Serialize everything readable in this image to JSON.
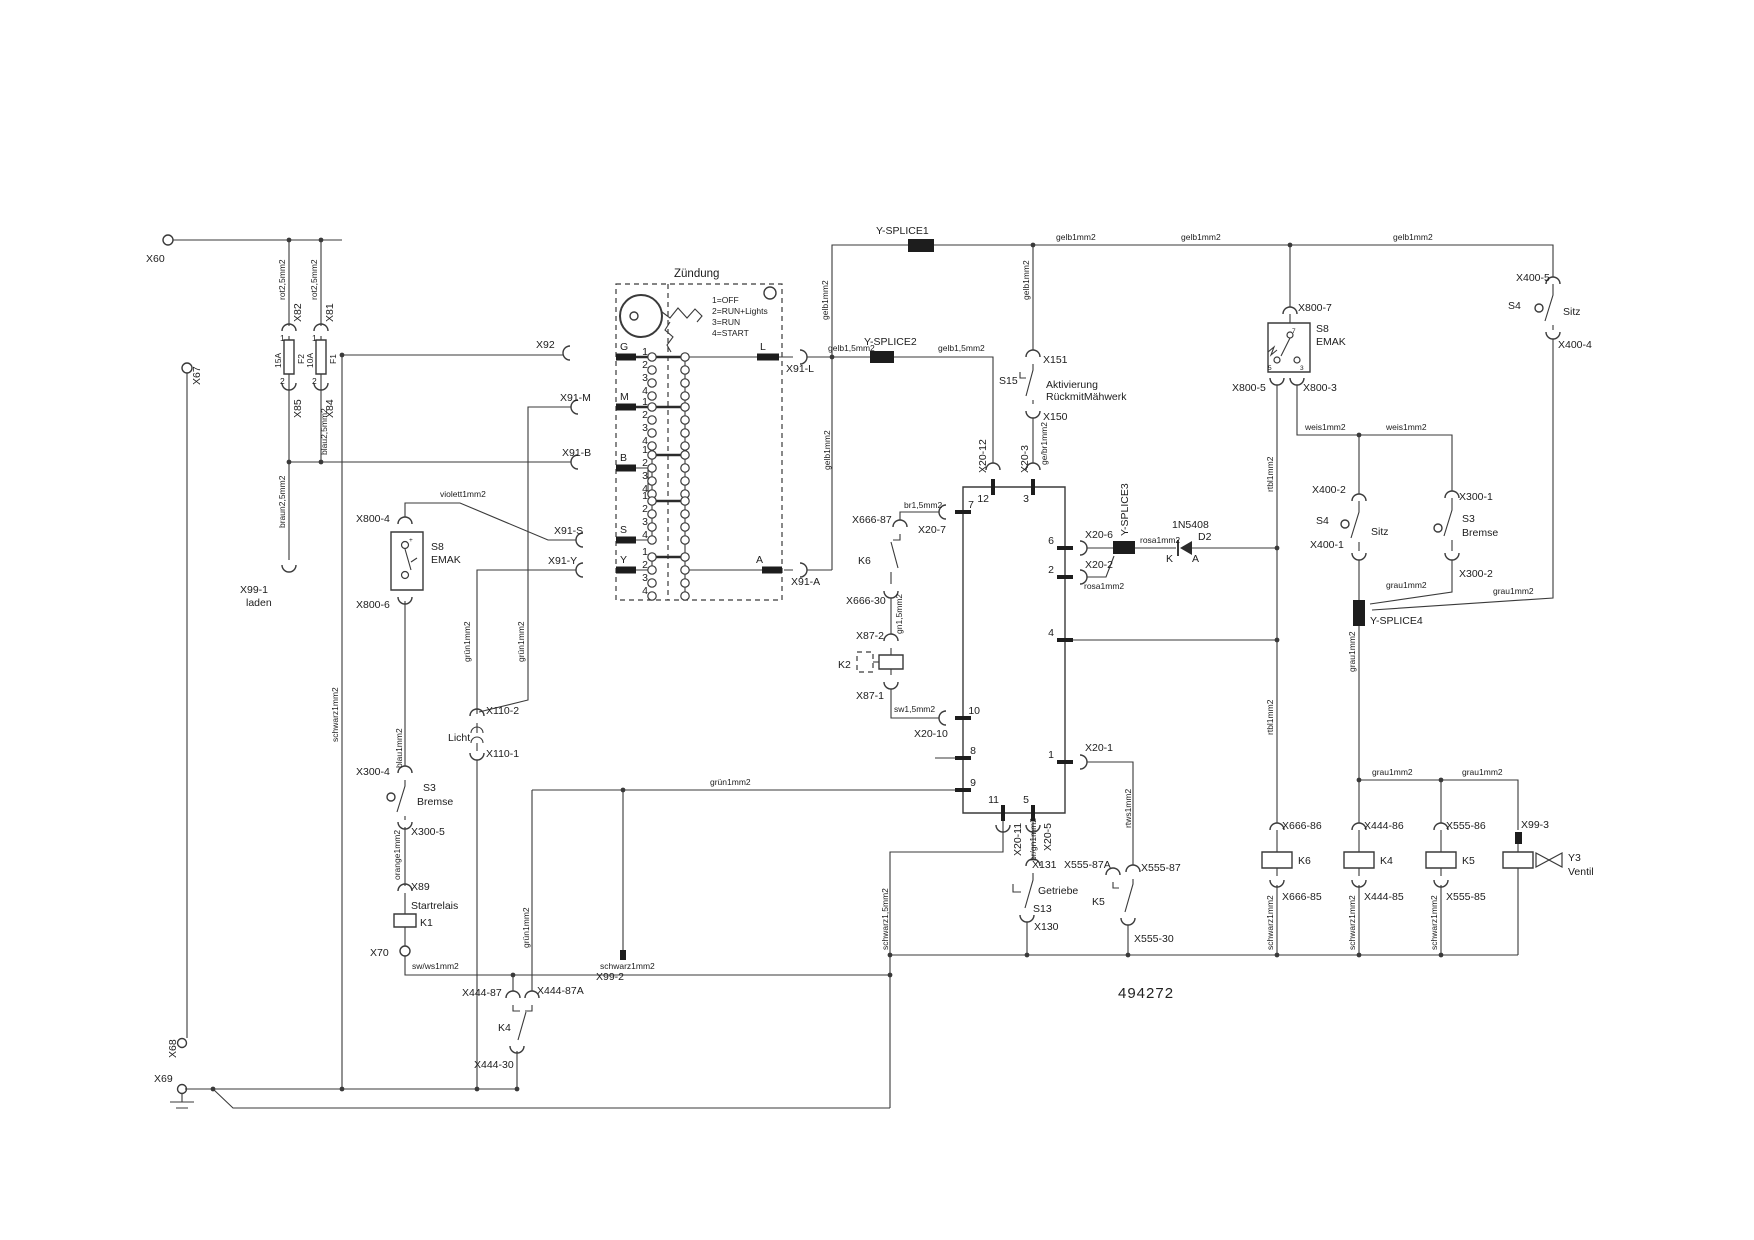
{
  "doc_number": "494272",
  "ignition": {
    "title": "Zündung",
    "pos1": "1=OFF",
    "pos2": "2=RUN+Lights",
    "pos3": "3=RUN",
    "pos4": "4=START",
    "terminals": {
      "g": "G",
      "m": "M",
      "b": "B",
      "s": "S",
      "y": "Y",
      "l": "L",
      "a": "A"
    }
  },
  "pins": {
    "p1": "1",
    "p2": "2",
    "p3": "3",
    "p4": "4",
    "p5": "5",
    "p6": "6",
    "p7": "7",
    "p8": "8",
    "p9": "9",
    "p10": "10",
    "p11": "11",
    "p12": "12"
  },
  "fuses": {
    "f1": "F1",
    "f2": "F2",
    "f1_rating": "10A",
    "f2_rating": "15A"
  },
  "wires": {
    "rot25": "rot2,5mm2",
    "blau25": "blau2,5mm2",
    "braun25": "braun2,5mm2",
    "schwarz1": "schwarz1mm2",
    "schwarz15": "schwarz1,5mm2",
    "swws1": "sw/ws1mm2",
    "sw15": "sw1,5mm2",
    "violett1": "violett1mm2",
    "blau1": "blau1mm2",
    "orange1": "orange1mm2",
    "gruen1": "grün1mm2",
    "gelb1": "gelb1mm2",
    "gelb15": "gelb1,5mm2",
    "br15": "br1,5mm2",
    "gn15": "gn1,5mm2",
    "rosa1": "rosa1mm2",
    "gebr1": "ge/br1mm2",
    "rtbl1": "rtbl1mm2",
    "rtws1": "rtws1mm2",
    "weis1": "weis1mm2",
    "grau1": "grau1mm2",
    "brgn1": "br/gn1mm2"
  },
  "connectors": {
    "x60": "X60",
    "x67": "X67",
    "x68": "X68",
    "x69": "X69",
    "x70": "X70",
    "x81": "X81",
    "x82": "X82",
    "x84": "X84",
    "x85": "X85",
    "x89": "X89",
    "x92": "X92",
    "x99_1": "X99-1",
    "laden": "laden",
    "x99_2": "X99-2",
    "x99_3": "X99-3",
    "x91_m": "X91-M",
    "x91_b": "X91-B",
    "x91_s": "X91-S",
    "x91_y": "X91-Y",
    "x91_l": "X91-L",
    "x91_a": "X91-A",
    "x110_1": "X110-1",
    "x110_2": "X110-2",
    "x130": "X130",
    "x131": "X131",
    "x150": "X150",
    "x151": "X151",
    "x300_1": "X300-1",
    "x300_2": "X300-2",
    "x300_4": "X300-4",
    "x300_5": "X300-5",
    "x400_1": "X400-1",
    "x400_2": "X400-2",
    "x400_4": "X400-4",
    "x400_5": "X400-5",
    "x444_30": "X444-30",
    "x444_85": "X444-85",
    "x444_86": "X444-86",
    "x444_87": "X444-87",
    "x444_87a": "X444-87A",
    "x555_30": "X555-30",
    "x555_85": "X555-85",
    "x555_86": "X555-86",
    "x555_87": "X555-87",
    "x555_87a": "X555-87A",
    "x666_30": "X666-30",
    "x666_85": "X666-85",
    "x666_86": "X666-86",
    "x666_87": "X666-87",
    "x87_1": "X87-1",
    "x87_2": "X87-2",
    "x800_3": "X800-3",
    "x800_4": "X800-4",
    "x800_5": "X800-5",
    "x800_6": "X800-6",
    "x800_7": "X800-7",
    "x20_1": "X20-1",
    "x20_2": "X20-2",
    "x20_3": "X20-3",
    "x20_5": "X20-5",
    "x20_6": "X20-6",
    "x20_7": "X20-7",
    "x20_10": "X20-10",
    "x20_11": "X20-11",
    "x20_12": "X20-12"
  },
  "components": {
    "s3": "S3",
    "s4": "S4",
    "s8": "S8",
    "s13": "S13",
    "s15": "S15",
    "emak": "EMAK",
    "bremse": "Bremse",
    "sitz": "Sitz",
    "licht": "Licht",
    "getriebe": "Getriebe",
    "startrelais": "Startrelais",
    "k1": "K1",
    "k2": "K2",
    "k4": "K4",
    "k5": "K5",
    "k6": "K6",
    "y3": "Y3",
    "ventil": "Ventil",
    "d2": "D2",
    "d2_type": "1N5408",
    "diode_k": "K",
    "diode_a": "A",
    "aktivierung": "Aktivierung",
    "rueckmit": "RückmitMähwerk",
    "plus": "+"
  },
  "splices": {
    "s1": "Y-SPLICE1",
    "s2": "Y-SPLICE2",
    "s3": "Y-SPLICE3",
    "s4": "Y-SPLICE4"
  }
}
